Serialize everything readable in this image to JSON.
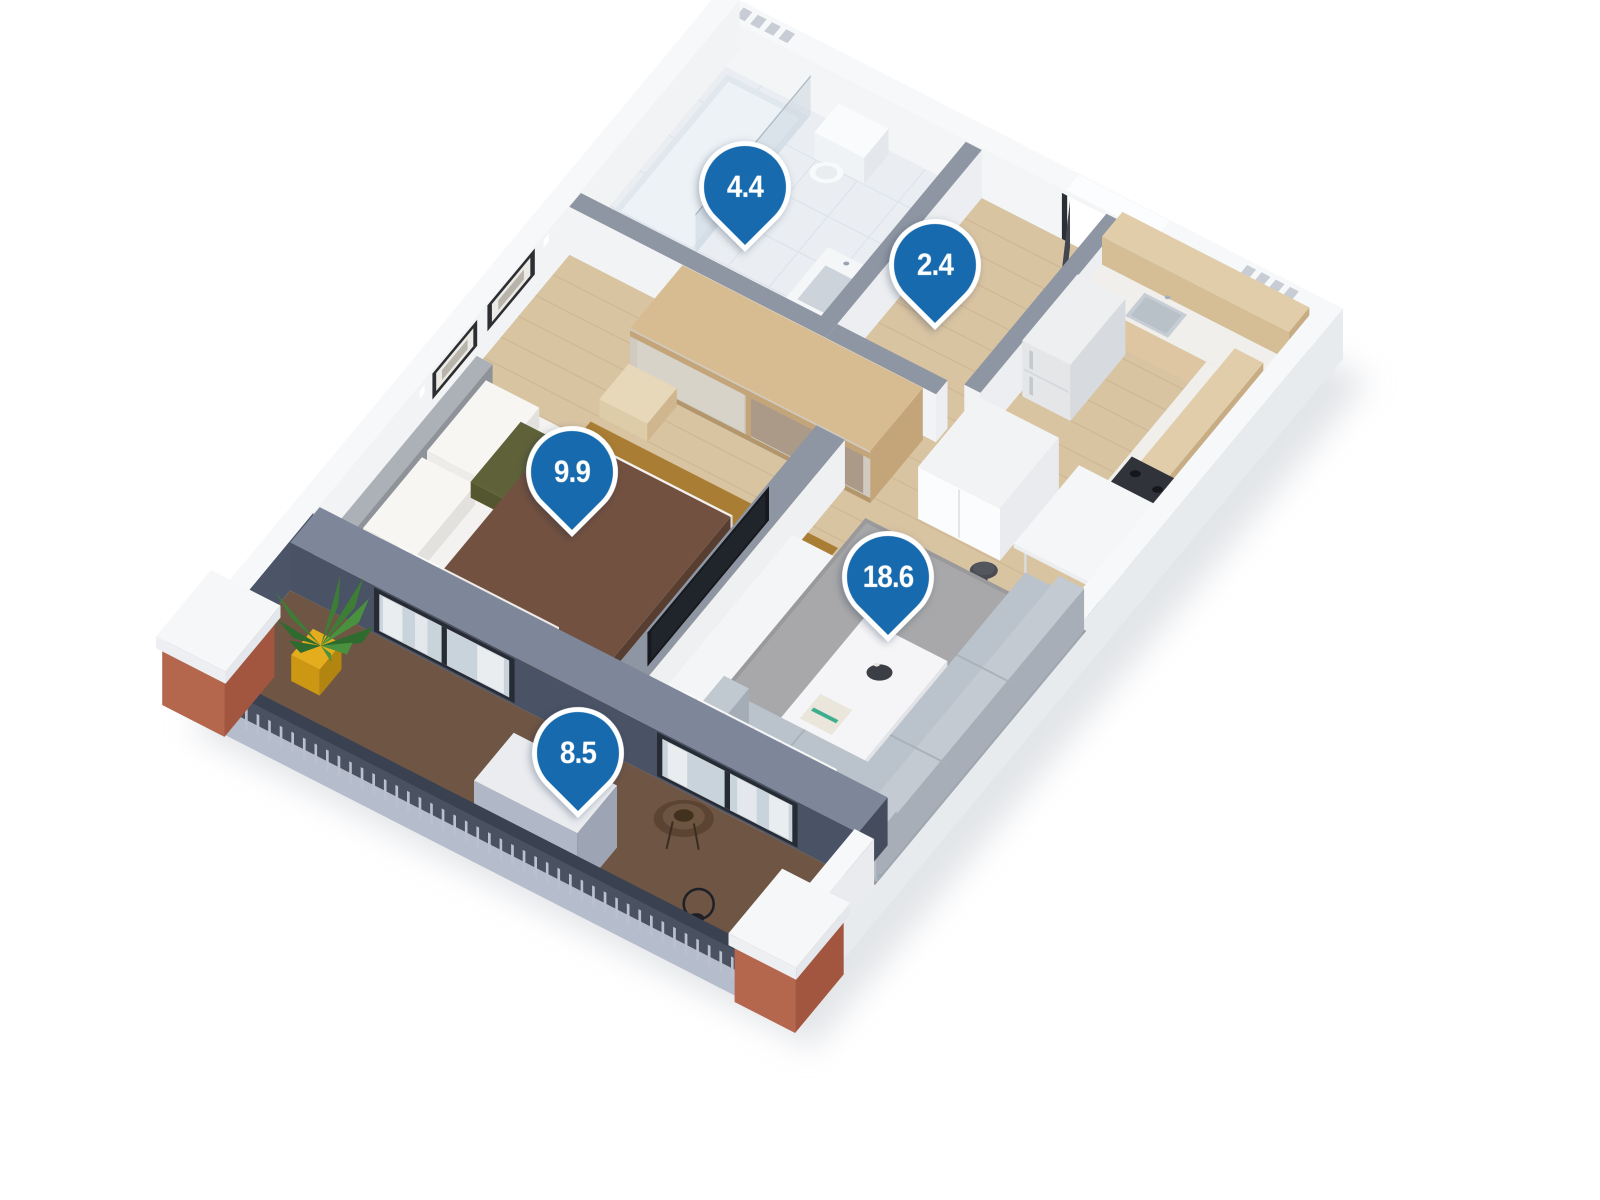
{
  "title": "3D apartment floor plan with room areas",
  "markers": [
    {
      "value": "4.4",
      "room": "bathroom"
    },
    {
      "value": "2.4",
      "room": "hallway"
    },
    {
      "value": "9.9",
      "room": "bedroom"
    },
    {
      "value": "18.6",
      "room": "living-room-kitchen"
    },
    {
      "value": "8.5",
      "room": "balcony"
    }
  ],
  "colors": {
    "pin": "#176aae",
    "pin_border": "#ffffff",
    "pin_text": "#ffffff",
    "outer_wall": "#f7f8fa",
    "inner_wall_top": "#8e96a3",
    "wood_floor": "#d9c4a2",
    "bathroom_tile": "#eaeef2",
    "balcony_deck": "#6f5544",
    "dark_facade": "#4a5265",
    "terracotta_column": "#b5674e",
    "rug_gray": "#a8a8aa",
    "rug_amber": "#aa7d34",
    "sofa": "#bac2cb",
    "kitchen_wood": "#d5bd96"
  }
}
